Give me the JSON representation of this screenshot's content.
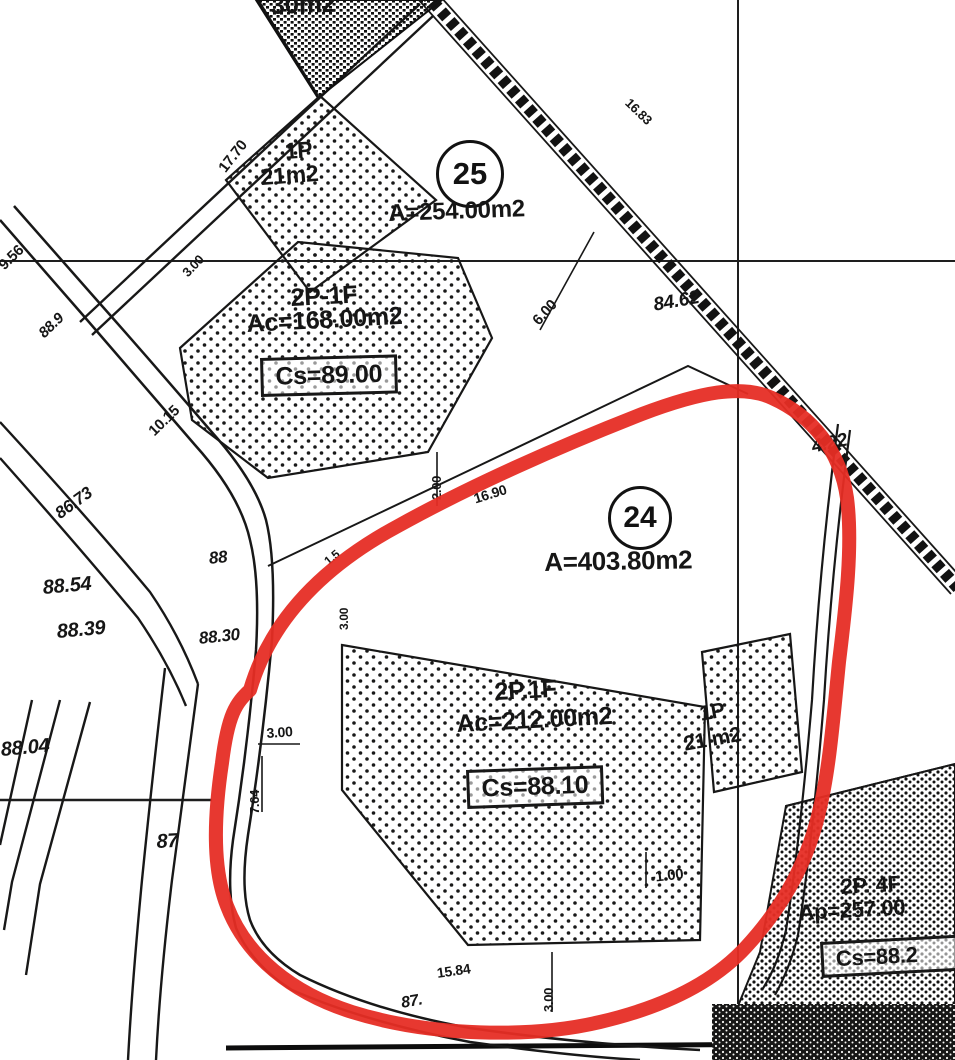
{
  "map_colors": {
    "ink": "#1a1a1a",
    "paper": "#fbfbfa",
    "highlight_outline": "#e23028"
  },
  "labels": {
    "shed_top_area": "30m2",
    "dim_17_70": "17.70",
    "bld25_small_floors": "1P",
    "bld25_small_area": "21m2",
    "parcel25_no": "25",
    "parcel25_area": "A=254.00m2",
    "dim_9_56": "9.56",
    "elev_88_9": "88.9",
    "dim_3_00_a": "3.00",
    "bld25_floors": "2P-1F",
    "bld25_area": "Ac=168.00m2",
    "bld25_cs": "Cs=89.00",
    "dim_10_15": "10.15",
    "elev_86_73": "86.73",
    "dim_6_00": "6.00",
    "dim_16_83": "16.83",
    "elev_84_62": "84.62",
    "elev_4_22": "4.22",
    "parcel24_no": "24",
    "parcel24_area": "A=403.80m2",
    "dim_16_90": "16.90",
    "dim_2_00": "2.00",
    "dim_1_5": "1.5",
    "dim_3_00_b": "3.00",
    "elev_88": "88",
    "elev_88_30": "88.30",
    "elev_88_54": "88.54",
    "elev_88_39": "88.39",
    "elev_88_04": "88.04",
    "elev_87": "87",
    "dim_3_00_c": "3.00",
    "dim_7_64": "7.64",
    "bld24_floors": "2P.1F",
    "bld24_area": "Ac=212.00m2",
    "bld24_cs": "Cs=88.10",
    "bld24_small_floors": "1P",
    "bld24_small_area": "21 m2",
    "dim_1_00": "-1.00",
    "dim_15_84": "15.84",
    "dim_3_00_d": "3.00",
    "elev_87_b": "87.",
    "bldSE_floors": "2P. 4F",
    "bldSE_area": "Ap=257.00",
    "bldSE_cs": "Cs=88.2"
  }
}
